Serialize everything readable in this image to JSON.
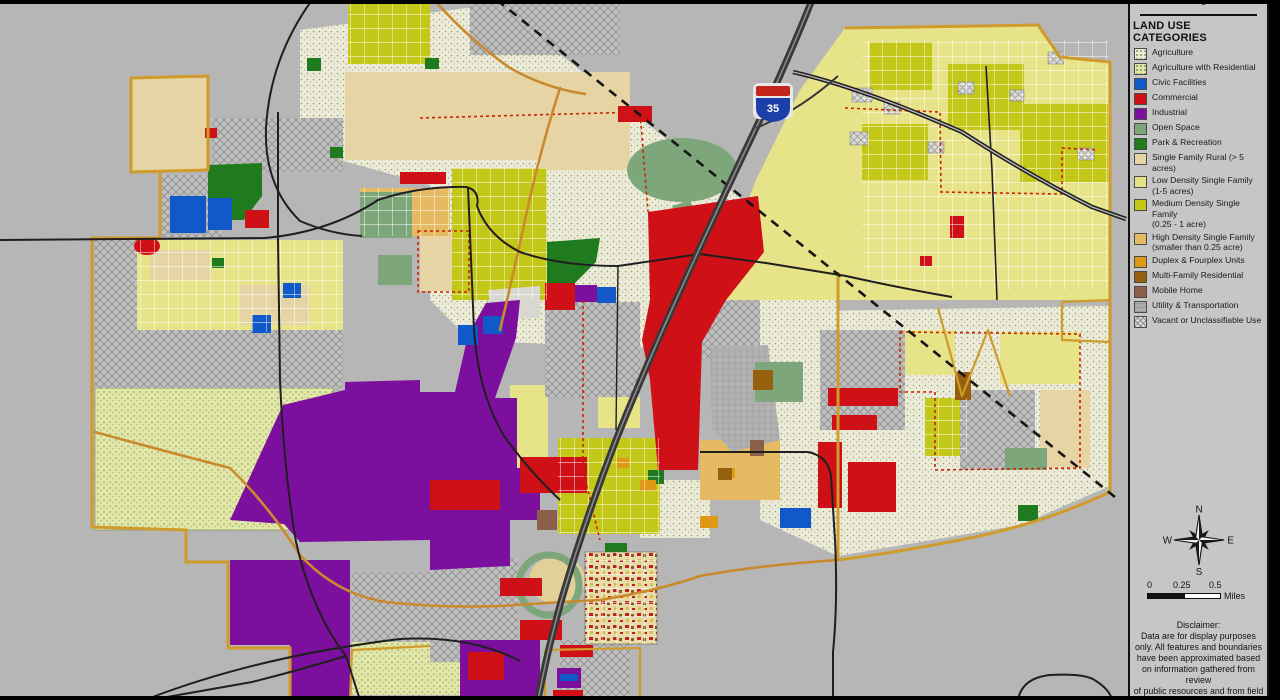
{
  "legend": {
    "clipped_title": "Planning Area",
    "header": "LAND USE CATEGORIES",
    "items": [
      {
        "label": "Agriculture",
        "color": "#ecebd9",
        "pattern": "sw-speckle-ag"
      },
      {
        "label": "Agriculture with Residential",
        "color": "#e3e7ae",
        "pattern": "sw-speckle-agres"
      },
      {
        "label": "Civic Facilities",
        "color": "#1158c9",
        "pattern": ""
      },
      {
        "label": "Commercial",
        "color": "#cf1016",
        "pattern": ""
      },
      {
        "label": "Industrial",
        "color": "#7d0f9f",
        "pattern": ""
      },
      {
        "label": "Open Space",
        "color": "#7ea67b",
        "pattern": ""
      },
      {
        "label": "Park & Recreation",
        "color": "#207b1f",
        "pattern": ""
      },
      {
        "label": "Single Family Rural (> 5 acres)",
        "color": "#e7d4a4",
        "pattern": ""
      },
      {
        "label": "Low Density Single Family\n(1-5 acres)",
        "color": "#e5e287",
        "pattern": ""
      },
      {
        "label": "Medium Density Single Family\n(0.25 - 1 acre)",
        "color": "#c3c718",
        "pattern": ""
      },
      {
        "label": "High Density Single Family\n(smaller than 0.25 acre)",
        "color": "#e6ba62",
        "pattern": ""
      },
      {
        "label": "Duplex & Fourplex Units",
        "color": "#de9916",
        "pattern": ""
      },
      {
        "label": "Multi-Family Residential",
        "color": "#96610f",
        "pattern": ""
      },
      {
        "label": "Mobile Home",
        "color": "#8c5f4a",
        "pattern": ""
      },
      {
        "label": "Utility & Transportation",
        "color": "#adadad",
        "pattern": "sw-util"
      },
      {
        "label": "Vacant or Unclassifiable Use",
        "color": "#dcdcd6",
        "pattern": "sw-hatch"
      }
    ]
  },
  "compass": {
    "n": "N",
    "s": "S",
    "e": "E",
    "w": "W"
  },
  "scale_bar": {
    "tick_start": "0",
    "tick_mid": "0.25",
    "tick_end": "0.5",
    "unit": "Miles"
  },
  "disclaimer": {
    "title": "Disclaimer:",
    "lines": [
      "Data are for display purposes",
      "only.  All features and boundaries",
      "have been approximated based",
      "on information gathered from review",
      "of public resources and from field",
      "reconnaissance."
    ]
  },
  "map": {
    "shield": "35",
    "colors": {
      "background": "#b6b6b6",
      "boundary": "#cf9b2a",
      "road": "#1f1f1f",
      "highway": "#383838",
      "city_limits_dash": "#cc2200",
      "shield_red": "#c3241c",
      "shield_blue": "#1c3faa"
    }
  }
}
